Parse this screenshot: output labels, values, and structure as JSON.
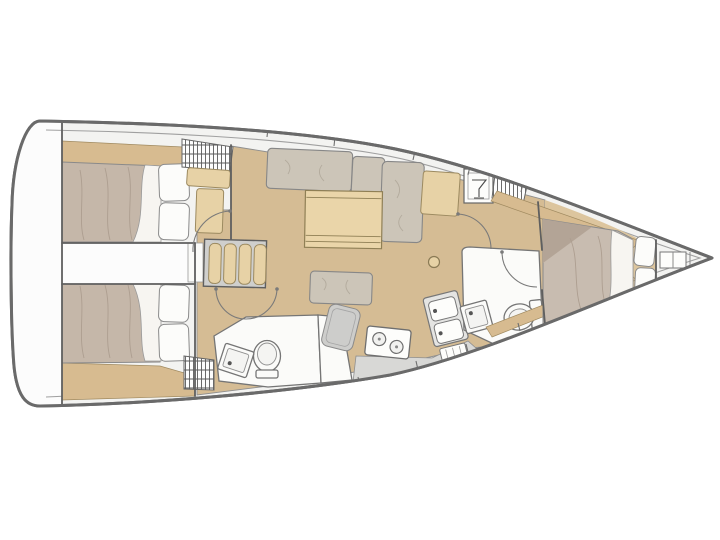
{
  "canvas": {
    "width": 720,
    "height": 540,
    "background": "#ffffff"
  },
  "diagram": {
    "type": "sailboat-interior-floor-plan",
    "view": "top-down",
    "orientation": {
      "bow": "right",
      "stern": "left"
    },
    "colors": {
      "outline": "#6a6a6a",
      "wall": "#5f5f5f",
      "deck_white": "#f3f3f1",
      "transom_white": "#fcfcfc",
      "salon_floor_tan": "#d5bc94",
      "cabin_floor_tan": "#dcc59e",
      "wood_tan": "#e7d2a6",
      "shelf_tan": "#d7bb90",
      "duvet_taupe": "#c5b7a9",
      "duvet_shadow": "#b3a496",
      "cushion_gray": "#ccc5b8",
      "cushion_stroke": "#878787",
      "fixture_white": "#fbfbf9",
      "fixture_stroke": "#757575",
      "counter_gray": "#d8d8d6",
      "tray_gray": "#cdcdcb",
      "sheet_white": "#f7f5f1"
    },
    "rooms": [
      {
        "id": "aft-cabin-port",
        "label": "Aft double cabin, port side"
      },
      {
        "id": "aft-cabin-starboard",
        "label": "Aft double cabin, starboard side"
      },
      {
        "id": "engine-space",
        "label": "Engine space between aft cabins"
      },
      {
        "id": "saloon",
        "label": "Saloon with L-settee, table and ottoman"
      },
      {
        "id": "galley",
        "label": "Galley with two-burner stove and twin sinks"
      },
      {
        "id": "aft-head",
        "label": "Aft head with toilet, basin and shower"
      },
      {
        "id": "forward-head",
        "label": "Forward head with toilet and basin"
      },
      {
        "id": "forward-cabin",
        "label": "Forward owner cabin with double berth"
      },
      {
        "id": "companionway",
        "label": "Companionway steps"
      },
      {
        "id": "bow-locker",
        "label": "Bow anchor locker"
      },
      {
        "id": "transom",
        "label": "Stern transom platform"
      }
    ],
    "furniture": [
      "double-berth",
      "pillows",
      "hanging-locker",
      "companionway-steps",
      "l-settee",
      "saloon-table",
      "ottoman",
      "table-pedestal",
      "cabin-seat",
      "wet-bar-cabinet",
      "toilet",
      "washbasin",
      "shower-stall",
      "shower-tray",
      "stove",
      "twin-sink",
      "galley-counter",
      "door-swing",
      "bow-shelf"
    ]
  }
}
